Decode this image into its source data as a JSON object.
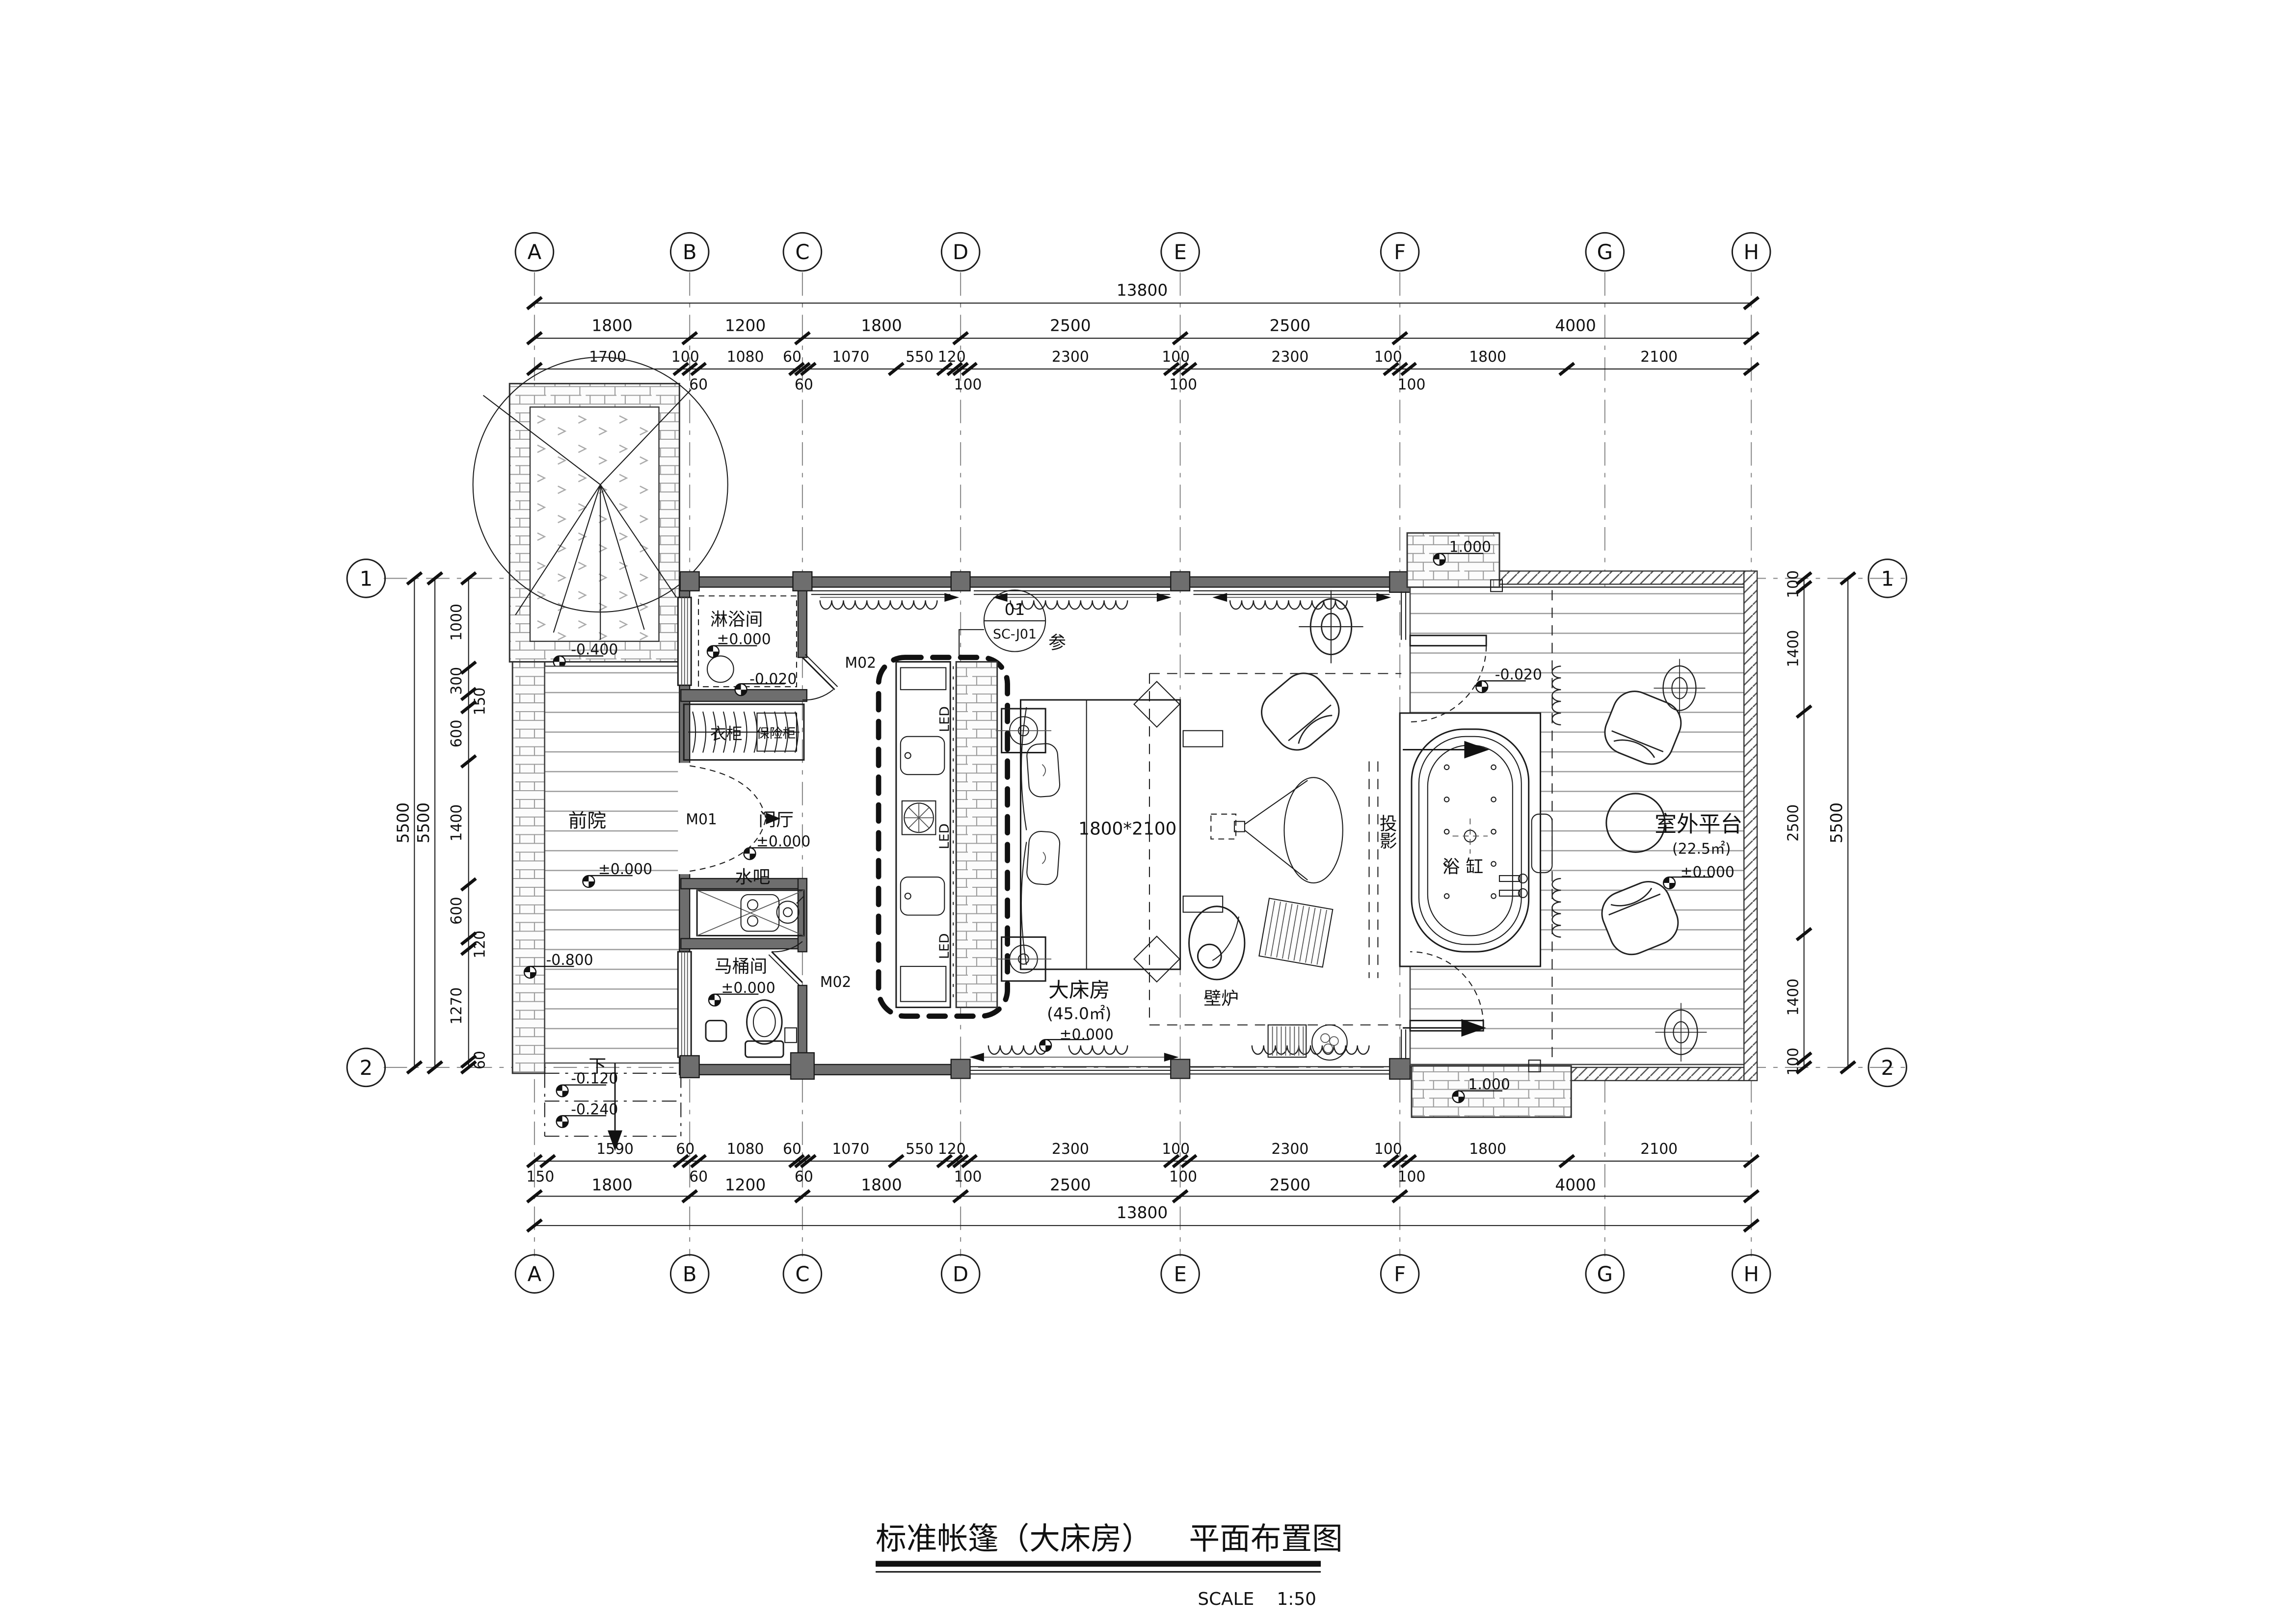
{
  "title": {
    "main": "标准帐篷（大床房）",
    "sub": "平面布置图",
    "scale_label": "SCALE",
    "scale_value": "1:50"
  },
  "grid": {
    "cols": [
      "A",
      "B",
      "C",
      "D",
      "E",
      "F",
      "G",
      "H"
    ],
    "rows": [
      "1",
      "2"
    ]
  },
  "dims": {
    "top_total": "13800",
    "top_major": [
      "1800",
      "1200",
      "1800",
      "2500",
      "2500",
      "4000"
    ],
    "top_minor": [
      "1700",
      "100",
      "1080",
      "60",
      "1070",
      "550",
      "120",
      "2300",
      "100",
      "2300",
      "100",
      "1800",
      "2100"
    ],
    "top_sub": [
      "60",
      "60",
      "100",
      "100",
      "100"
    ],
    "bottom_total": "13800",
    "bottom_major": [
      "1800",
      "1200",
      "1800",
      "2500",
      "2500",
      "4000"
    ],
    "bottom_minor": [
      "1590",
      "60",
      "1080",
      "60",
      "1070",
      "550",
      "120",
      "2300",
      "100",
      "2300",
      "100",
      "1800",
      "2100"
    ],
    "bottom_sub": [
      "150",
      "60",
      "60",
      "100",
      "100",
      "100"
    ],
    "left_overall": [
      "5500",
      "5500"
    ],
    "left_chain": [
      "1000",
      "300",
      "150",
      "600",
      "1400",
      "600",
      "120",
      "1270",
      "60"
    ],
    "right_chain": [
      "100",
      "1400",
      "2500",
      "1400",
      "100"
    ],
    "right_overall": "5500"
  },
  "rooms": {
    "front_yard": "前院",
    "shower": "淋浴间",
    "hall": "门厅",
    "toilet": "马桶间",
    "water_bar": "水吧",
    "bedroom": "大床房",
    "bedroom_area": "(45.0㎡)",
    "terrace": "室外平台",
    "terrace_area": "(22.5㎡)",
    "wardrobe": "衣柜",
    "safe": "保险柜",
    "bathtub": "浴缸",
    "fireplace": "壁炉",
    "projection": "投影",
    "down": "下",
    "led": "LED"
  },
  "levels": {
    "zero": "±0.000",
    "minus020": "-0.020",
    "minus040": "-0.400",
    "minus080": "-0.800",
    "minus012": "-0.120",
    "minus024": "-0.240",
    "plus100": "1.000"
  },
  "doors": {
    "m01": "M01",
    "m02": "M02"
  },
  "detail": {
    "num": "01",
    "ref": "SC-J01",
    "note": "参"
  },
  "bed": {
    "size": "1800*2100"
  }
}
